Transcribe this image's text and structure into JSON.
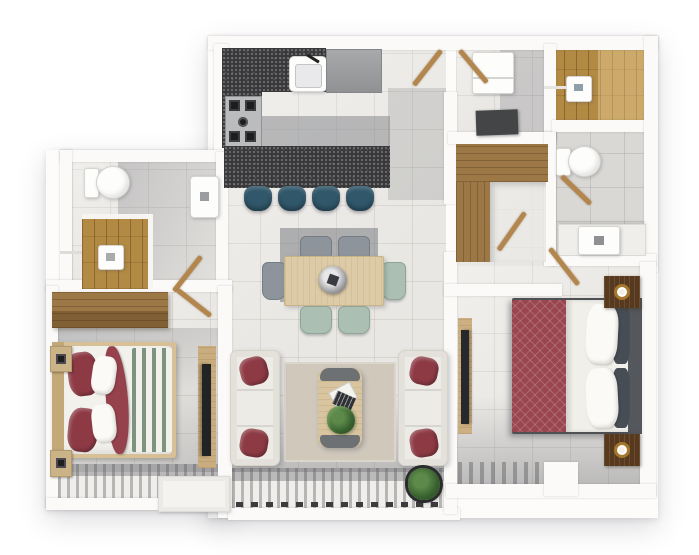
{
  "image": {
    "kind": "3D top-down architectural floor plan rendering",
    "text_labels": [],
    "palette": {
      "background": "#ffffff",
      "walls": "#fbfaf8",
      "floor_tile": "#e9e7e3",
      "gray_tile": "#d9d8d5",
      "granite_counter": "#39393b",
      "wood_deck": "#b28a44",
      "wardrobe_wood": "#9c7847",
      "light_wood": "#ddcba8",
      "stool_teal": "#30576a",
      "chair_sage": "#abc0b3",
      "sofa_white": "#edebe6",
      "pillow_red": "#8d3a44",
      "master_duvet_maroon": "#9a4650",
      "headboard_gray": "#54575b",
      "nightstand_walnut": "#56391e",
      "blanket_stripe_green": "#7e937f",
      "plant_green": "#39612f",
      "balcony_deck_stripe": "#b7b6b3"
    }
  },
  "rooms": [
    {
      "id": "kitchen",
      "name": "Kitchen",
      "furniture": [
        "L-shaped granite counter",
        "sink with faucet",
        "4-burner gas cooktop",
        "refrigerator",
        "breakfast island",
        "4 teal bar stools"
      ]
    },
    {
      "id": "dining-area",
      "name": "Dining Area",
      "furniture": [
        "light-wood dining table",
        "6 chairs (sage seats)",
        "decorative centerpiece bowl"
      ]
    },
    {
      "id": "living-room",
      "name": "Living Room",
      "furniture": [
        "2 white three-seat sofas",
        "4 red throw pillows",
        "wood coffee table",
        "magazines",
        "small plant",
        "beige area rug",
        "potted plant"
      ]
    },
    {
      "id": "bedroom-2",
      "name": "Bedroom 2",
      "furniture": [
        "double bed with white duvet",
        "red pillows and red throw",
        "green striped blanket",
        "2 nightstands with black lamps",
        "wood wardrobe",
        "wall TV panel"
      ]
    },
    {
      "id": "bathroom-2",
      "name": "Bathroom 2",
      "furniture": [
        "toilet",
        "wood-deck shower",
        "wall-hung basin"
      ]
    },
    {
      "id": "utility-room",
      "name": "Utility Room",
      "furniture": [
        "white appliance",
        "dark counter slab"
      ]
    },
    {
      "id": "master-shower",
      "name": "Master Shower Deck",
      "furniture": [
        "wood plank deck",
        "white shower shelf"
      ]
    },
    {
      "id": "master-bathroom",
      "name": "Master Bathroom",
      "furniture": [
        "toilet",
        "vanity counter with basin"
      ]
    },
    {
      "id": "walk-in-closet",
      "name": "Walk-in Closet",
      "furniture": [
        "L-shaped wood wardrobe"
      ]
    },
    {
      "id": "master-bedroom",
      "name": "Master Bedroom",
      "furniture": [
        "double bed with maroon diamond duvet",
        "white and navy pillows",
        "gray headboard",
        "2 walnut nightstands with cups",
        "TV console"
      ]
    },
    {
      "id": "balcony-left",
      "name": "Balcony (Bedroom 2)",
      "furniture": [
        "striped deck",
        "white planter box"
      ]
    },
    {
      "id": "balcony-right",
      "name": "Balcony (Living Room)",
      "furniture": [
        "striped deck",
        "potted plant"
      ]
    }
  ],
  "counts": {
    "bar_stools": 4,
    "dining_chairs": 6,
    "sofas": 2,
    "beds": 2,
    "toilets": 2,
    "basins": 2,
    "nightstands": 4,
    "plants": 3,
    "door_leaves": 7
  }
}
